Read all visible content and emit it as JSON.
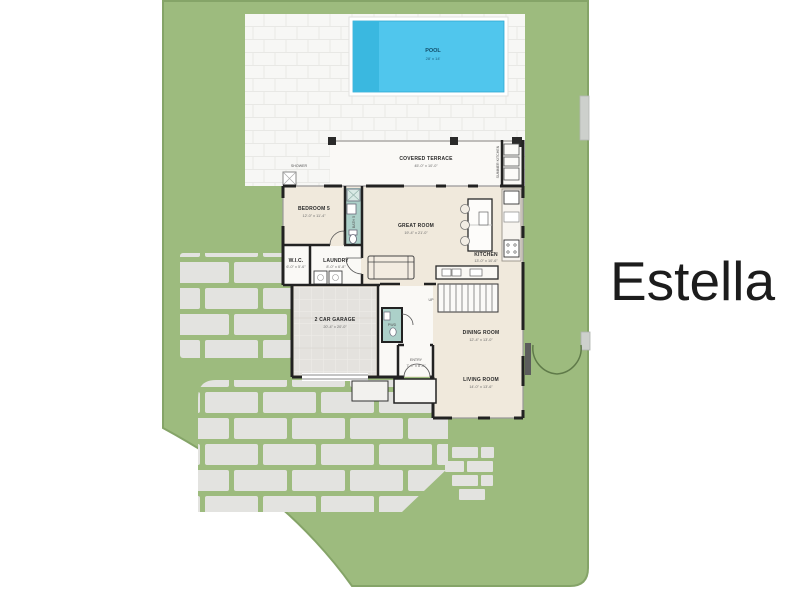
{
  "title": "Estella",
  "colors": {
    "lot_green": "#9DBB7E",
    "lot_edge": "#85A468",
    "paver_gray": "#E3E3E0",
    "deck_white": "#F7F7F5",
    "deck_line": "#E8E8E5",
    "floor_beige": "#F0E9DC",
    "floor_white": "#FAF9F6",
    "tile_teal": "#ACD0C9",
    "wall_dark": "#222222",
    "pool_water": "#50C6ED",
    "pool_shelf": "#3AB8E0",
    "garage_floor": "#E4E2DE",
    "fence_gray": "#CDD0CC"
  },
  "pool": {
    "label": "POOL",
    "dims": "28' x 14'"
  },
  "site": {
    "shower_label": "SHOWER",
    "summer_kitchen_label": "SUMMER KITCHEN"
  },
  "rooms": {
    "covered_terrace": {
      "label": "COVERED TERRACE",
      "dims": "45'-0\" x 10'-0\""
    },
    "great_room": {
      "label": "GREAT ROOM",
      "dims": "19'-4\" x 21'-0\""
    },
    "kitchen": {
      "label": "KITCHEN",
      "dims": "13'-0\" x 10'-6\""
    },
    "bedroom_5": {
      "label": "BEDROOM 5",
      "dims": "12'-0\" x 11'-4\""
    },
    "bath_5": {
      "label": "BATH 5"
    },
    "wic": {
      "label": "W.I.C.",
      "dims": "6'-0\" x 5'-6\""
    },
    "laundry": {
      "label": "LAUNDRY",
      "dims": "8'-0\" x 6'-8\""
    },
    "powder": {
      "label": "PWD"
    },
    "garage": {
      "label": "2 CAR GARAGE",
      "dims": "20'-4\" x 20'-0\""
    },
    "entry": {
      "label": "ENTRY",
      "dims": "7'-0\" x 8'-0\""
    },
    "dining_room": {
      "label": "DINING ROOM",
      "dims": "12'-4\" x 13'-0\""
    },
    "living_room": {
      "label": "LIVING ROOM",
      "dims": "14'-0\" x 13'-6\""
    },
    "stairs": {
      "label": "UP"
    }
  }
}
